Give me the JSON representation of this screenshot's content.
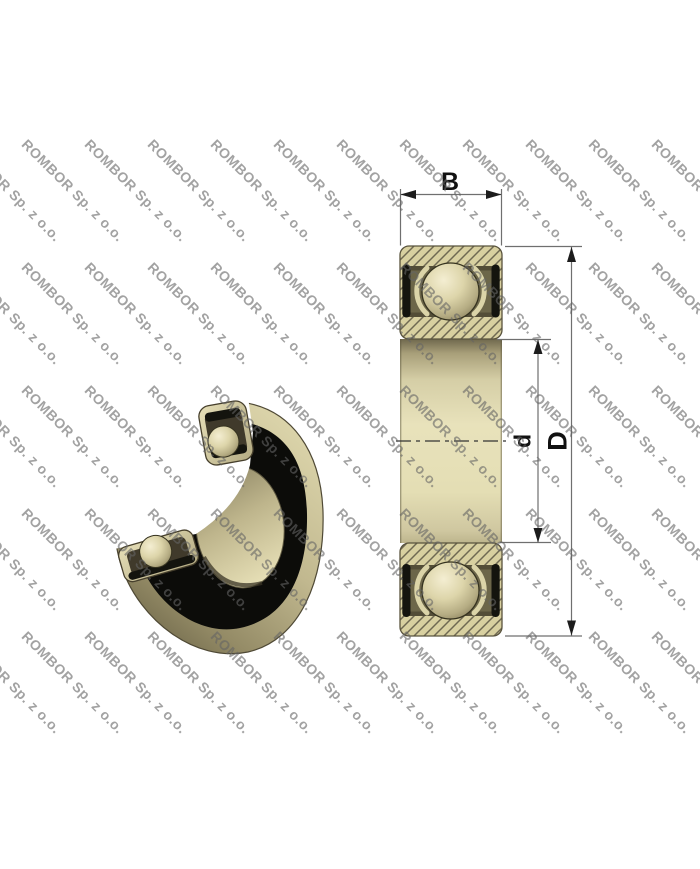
{
  "page": {
    "background": "#ffffff",
    "width": 700,
    "height": 869
  },
  "watermark": {
    "text": "ROMBOR Sp. z o.o.",
    "color": "rgba(100,100,100,0.6)"
  },
  "drawing": {
    "type": "technical-drawing",
    "subject": "Sealed deep groove ball bearing: 3D cutaway view (left) and dimensioned cross-section view (right)",
    "views": {
      "left": "3d-cutaway-view",
      "right": "cross-section-view"
    },
    "dimensions": {
      "width_label": "B",
      "bore_diameter_label": "d",
      "outer_diameter_label": "D"
    },
    "colors": {
      "body_khaki": "#d8d0a0",
      "hatch_line": "#6f6952",
      "cavity_olive": "#6c6649",
      "seal_black": "#14140e",
      "ball_highlight": "#f4eed2",
      "ball_shadow": "#8f8662",
      "bore_light": "#e8e2bb",
      "dimension_line": "#6f6f6f",
      "arrow": "#1c1c1c"
    }
  }
}
